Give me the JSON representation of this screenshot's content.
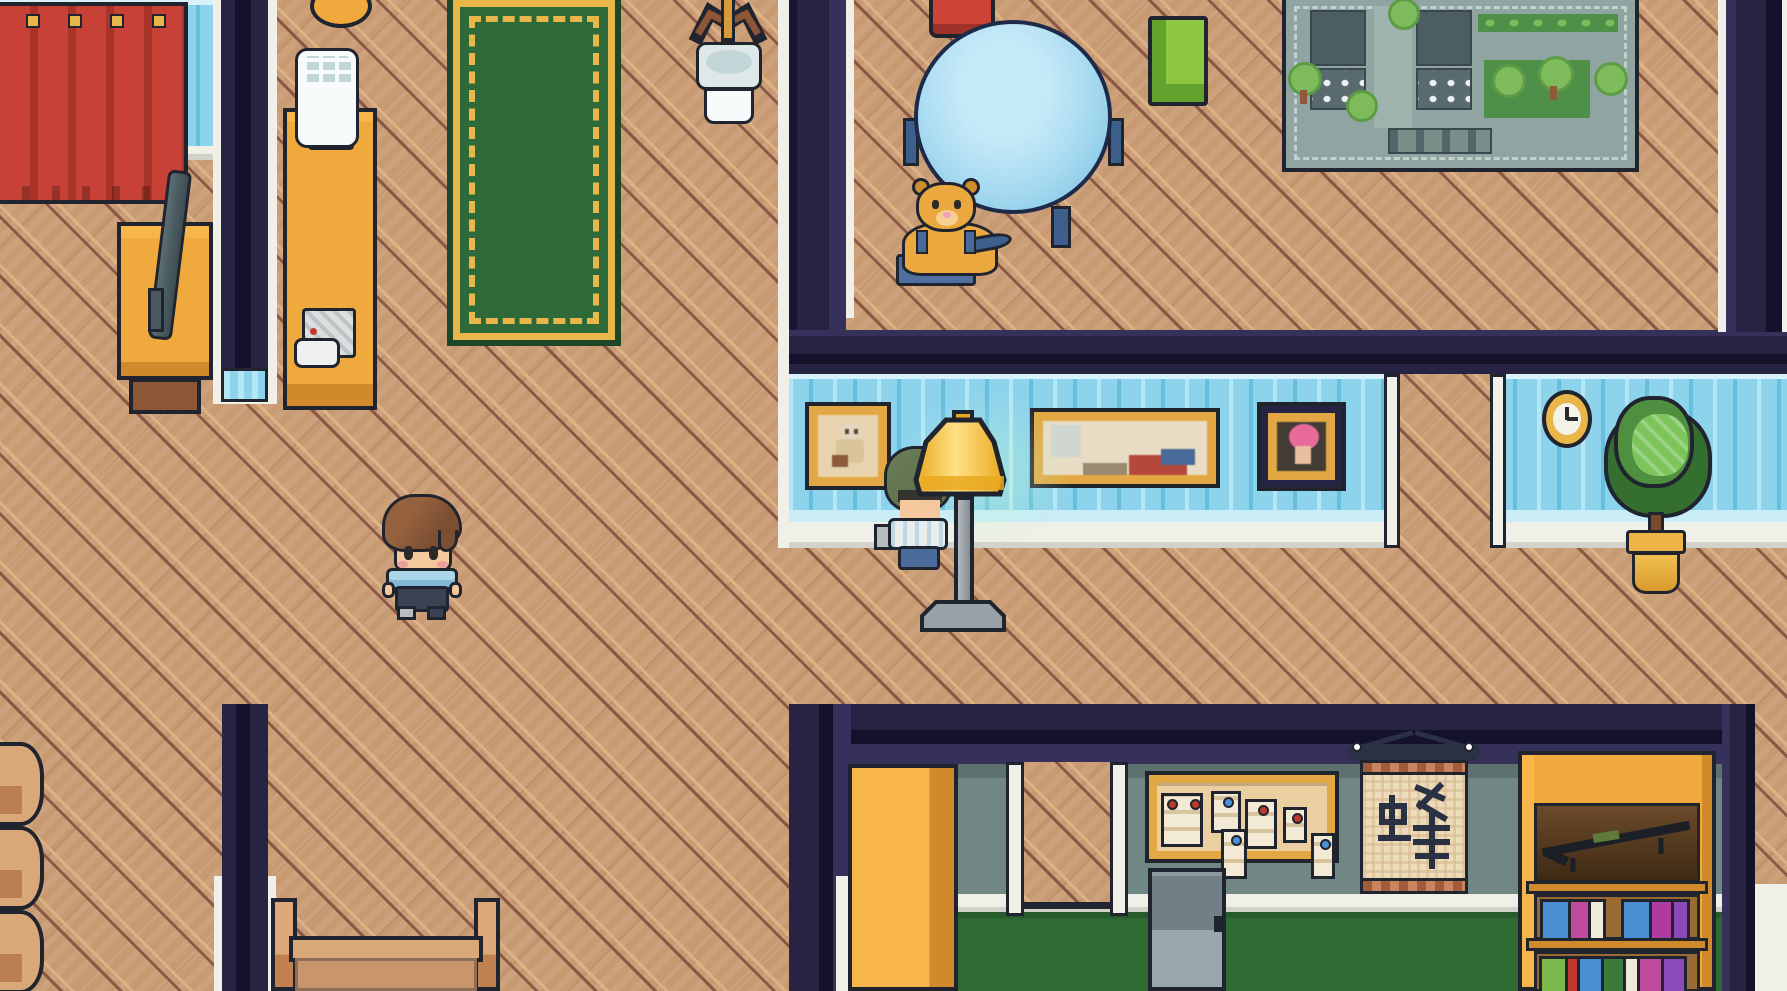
{
  "meta": {
    "view": "top-down pixel-art house interior",
    "type": "game-scene"
  },
  "palette": {
    "floorBase": "#c89a72",
    "floorLight": "#ddb284",
    "floorDark": "#8c5846",
    "navy": "#272343",
    "navyDark": "#14112b",
    "navyMid": "#36315a",
    "trim": "#f0efe8",
    "wpBase": "#8ed3ec",
    "wpLight": "#b5e6f6",
    "wpDark": "#68bedd",
    "wpPale": "#d8f1fa",
    "curtain": "#c84136",
    "curtainDark": "#a83328",
    "gold": "#e9b64a",
    "wood": "#efa93d",
    "woodDark": "#d08a2b",
    "woodDeep": "#a8701f",
    "brown": "#8d5636",
    "rugGreen": "#2e6a39",
    "rugDark": "#1e4728",
    "tableBlue": "#a6daf0",
    "tableEdge": "#7fc3e0",
    "legBlue": "#3e5e8c",
    "chairRed": "#cc4338",
    "chairRedDark": "#9e3129",
    "chairGreen": "#8cc73f",
    "chairGreenDark": "#63a22c",
    "bear": "#eaa83f",
    "bearDark": "#d08f2c",
    "muzzle": "#f6cf92",
    "overall": "#4a6b9a",
    "mapBase": "#90a5a1",
    "mapDash": "#c2d1cb",
    "mapBuilding": "#4d5e62",
    "mapBuildingDark": "#39484c",
    "mapWindow": "#eef2f2",
    "mapTree": "#7dbb5d",
    "mapTreeDark": "#5d9c44",
    "mapLawn": "#4f9049",
    "mapTrunk": "#8d5a3b",
    "mapPlaza": "#9eb2ae",
    "mapStairs": "#7a8e8a",
    "sage": "#718783",
    "sageDark": "#5d726f",
    "greenFloor": "#2e6b33",
    "cork": "#eccfa0",
    "boardFrame": "#e3a843",
    "paper": "#f3ead6",
    "paperLine": "#d9c4a0",
    "pinRed": "#c0392b",
    "pinBlue": "#4a90d9",
    "scrollPaper": "#ecdcba",
    "scrollCheck": "#d5b88e",
    "scrollTrim": "#a05c3c",
    "rod": "#2b3144",
    "locker": "#708086",
    "lockerLight": "#97a7ab",
    "skin": "#f4c89c",
    "hair": "#7c4f33",
    "hairLight": "#96613d",
    "eye": "#2a2a2a",
    "blush": "#eb9f9a",
    "shirt": "#abd6ea",
    "shirtDark": "#82b8d8",
    "pants": "#3b4253",
    "shoe": "#b9bec2",
    "hood": "#5c6d4b",
    "npcHair": "#35332f",
    "npcShirt": "#e9edee",
    "npcPants": "#4a6b9a",
    "itemGray": "#b8bcbc",
    "lamp": "#f7c93f",
    "lampLight": "#ffe187",
    "lampDark": "#e9a81f",
    "pole": "#9ba4a9",
    "lampBase": "#8b959a",
    "plant": "#4f9040",
    "plantDark": "#356f30",
    "plantLight": "#7cc45c",
    "pot": "#eeb446",
    "outline": "#20242e",
    "white": "#f8fbfb",
    "grayLight": "#dfe8e8",
    "grayMid": "#c2d6d8",
    "glow": "rgba(190,246,205,0.45)"
  },
  "objects": {
    "floor": "wooden parquet floor",
    "curtain": "red curtain",
    "tv": "television",
    "tvStand": "tv stand",
    "counter": "long counter",
    "appliance": "white machine",
    "stool": "wooden stool",
    "phone": "telephone",
    "rug": "green rug with gold border",
    "coatRack": "coat rack",
    "sink": "pedestal sink",
    "diningTable": "round blue table",
    "chairRed": "red chair",
    "chairGreen": "green chair",
    "teddyBear": "teddy bear on chair",
    "cityMap": "city map play rug",
    "pictureDoll": "framed doll picture",
    "painting": "framed painting",
    "picturePink": "framed portrait",
    "wallClock": "wall clock",
    "pottedTree": "potted tree",
    "floorLamp": "glowing floor lamp",
    "npc": "hooded villager",
    "player": "player character",
    "sideFurniture": "wooden furniture",
    "bed": "bed headboard",
    "cabinet": "yellow cabinet",
    "hallDoorway": "hallway doorway",
    "roomDoorway": "room doorway",
    "bulletinBoard": "bulletin board with notes",
    "note": "pinned note",
    "locker": "metal locker",
    "scroll": "hanging kanji scroll",
    "bookshelf": "bookshelf",
    "shelfItem": "item on shelf",
    "books": "books"
  }
}
